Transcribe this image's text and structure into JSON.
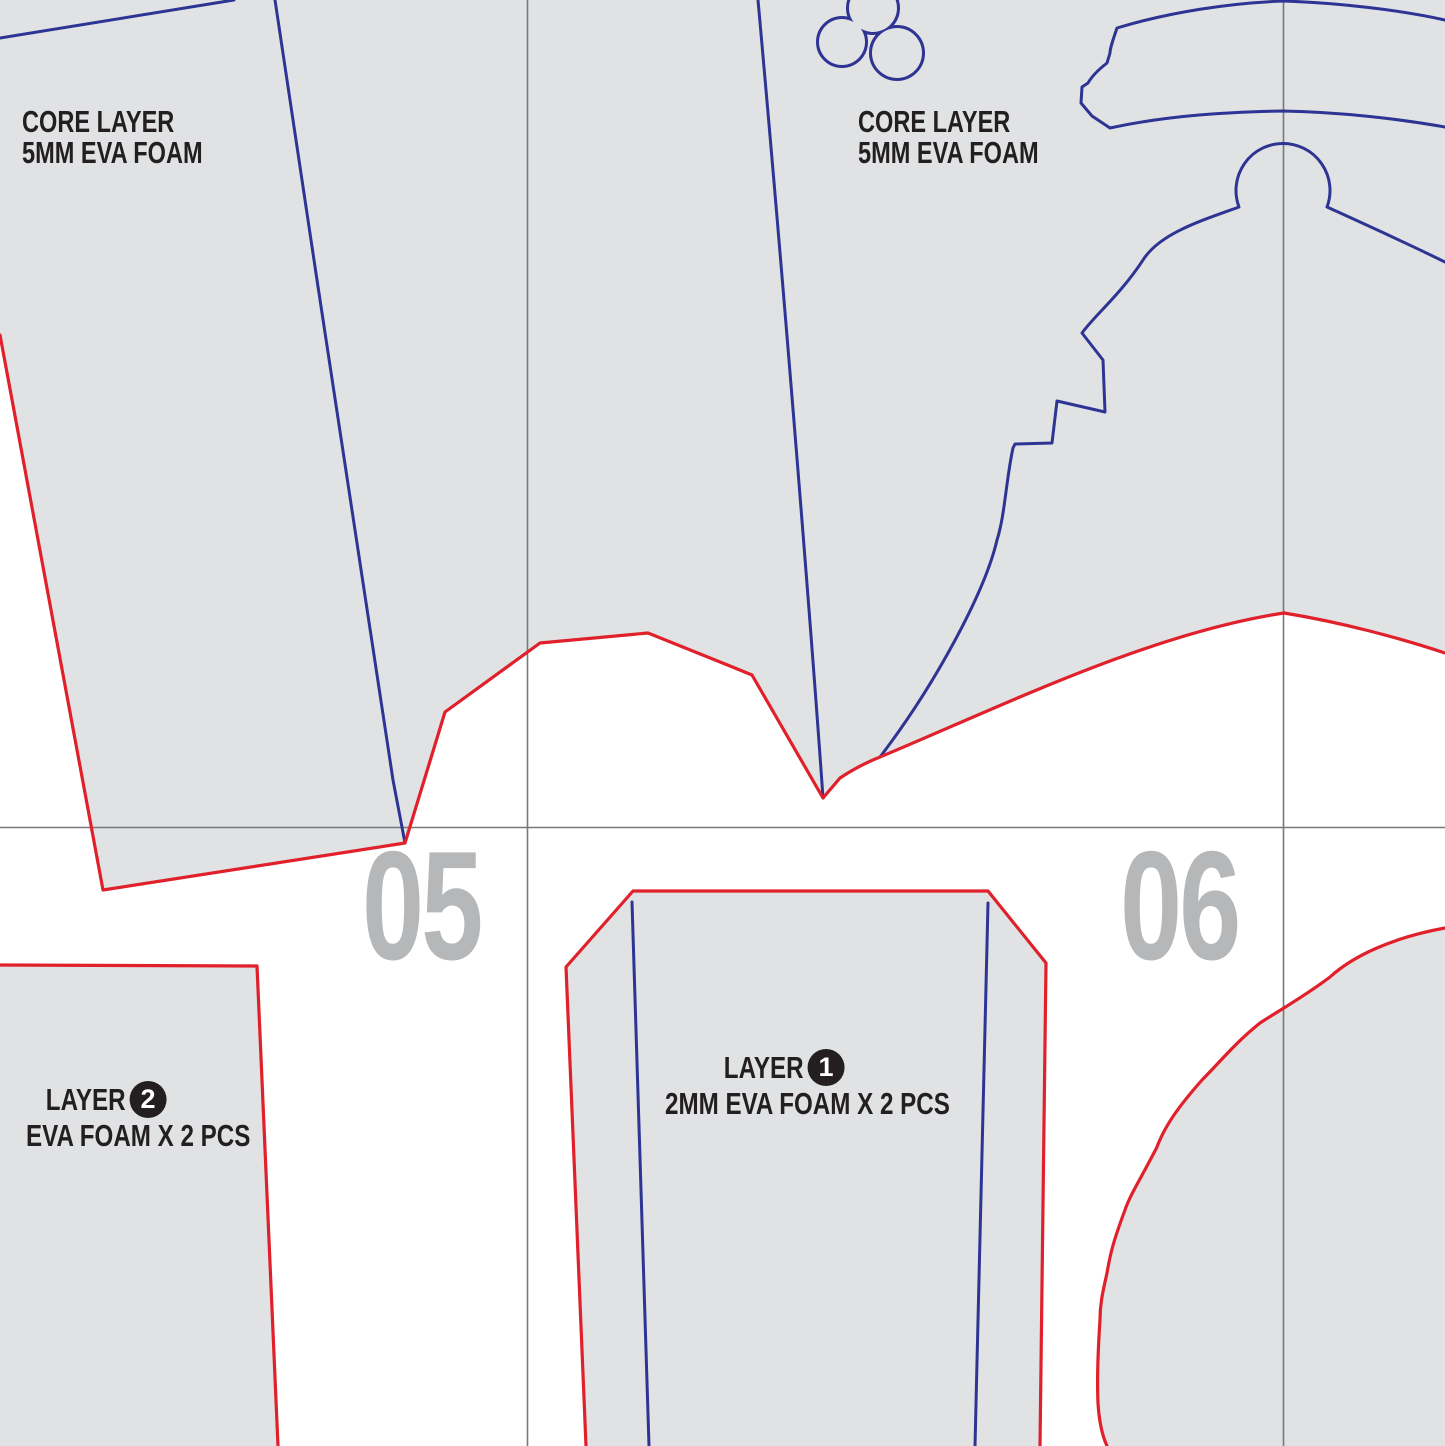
{
  "page_numbers": {
    "page_left": "05",
    "page_right": "06"
  },
  "labels": {
    "core_top_left": {
      "line1": "CORE LAYER",
      "line2": "5MM EVA FOAM"
    },
    "core_top_middle": {
      "line1": "CORE LAYER",
      "line2": "5MM EVA FOAM"
    },
    "layer_bottom_left": {
      "word": "LAYER",
      "number": "2",
      "line2": "EVA FOAM X 2 PCS"
    },
    "layer_bottom_middle": {
      "word": "LAYER",
      "number": "1",
      "line2": "2MM EVA FOAM X 2 PCS"
    }
  },
  "colors": {
    "cut_line_red": "#e0202a",
    "piece_line_blue": "#2d3494",
    "foam_fill_gray": "#e1e2e3",
    "grid_line_gray": "#77787b",
    "page_number_gray": "#b5b7b9",
    "label_ink": "#231f20",
    "background": "#ffffff"
  }
}
